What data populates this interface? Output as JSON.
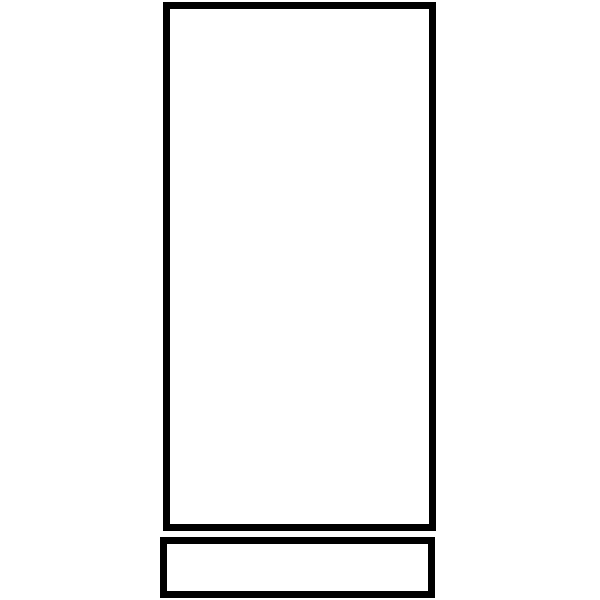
{
  "figure": {
    "description": "Black outline drawing of a tall vertical rectangle with a short wide rectangle beneath it",
    "background_color": "#ffffff",
    "stroke_color": "#000000",
    "shapes": [
      {
        "name": "tall-rectangle",
        "x": 163,
        "y": 2,
        "width": 273,
        "height": 529,
        "stroke_width": 7,
        "fill": "none"
      },
      {
        "name": "base-rectangle",
        "x": 160,
        "y": 537,
        "width": 275,
        "height": 61,
        "stroke_width": 7,
        "fill": "none"
      }
    ]
  }
}
